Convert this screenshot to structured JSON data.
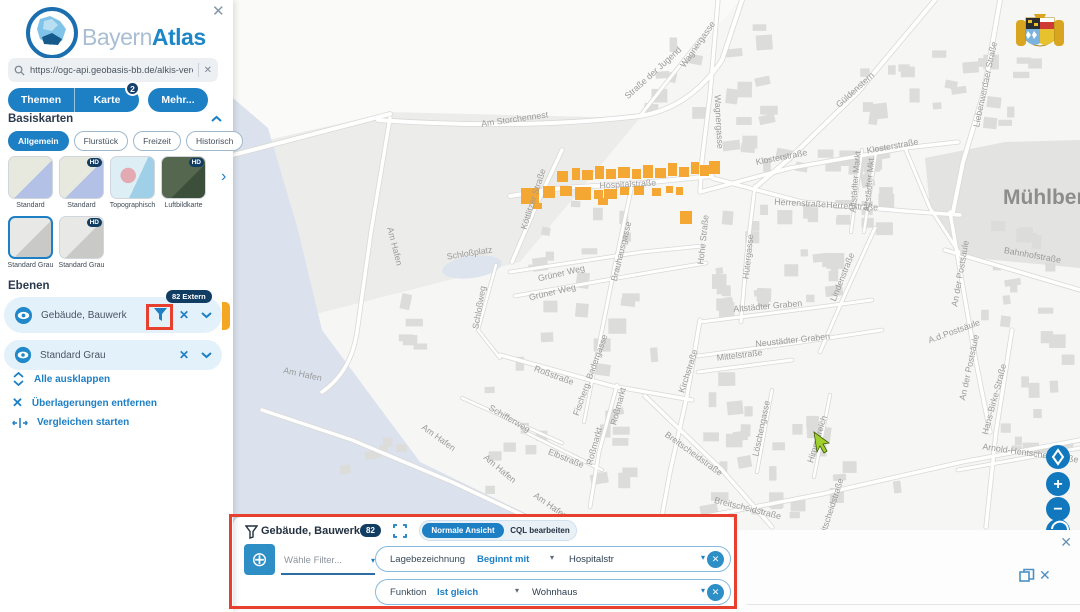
{
  "app": {
    "brand_first": "Bayern",
    "brand_second": "Atlas",
    "close_icon": "✕"
  },
  "search": {
    "value": "https://ogc-api.geobasis-bb.de/alkis-verein",
    "clear_icon": "✕"
  },
  "tabs": [
    {
      "label": "Themen"
    },
    {
      "label": "Karte",
      "badge": "2"
    },
    {
      "label": "Mehr..."
    }
  ],
  "basiskarten": {
    "title": "Basiskarten",
    "chips": [
      {
        "label": "Allgemein",
        "selected": true
      },
      {
        "label": "Flurstück",
        "selected": false
      },
      {
        "label": "Freizeit",
        "selected": false
      },
      {
        "label": "Historisch",
        "selected": false
      }
    ],
    "thumbnails": [
      {
        "label": "Standard",
        "hd": false,
        "selected": false,
        "variant": "standard",
        "row": 0,
        "col": 0
      },
      {
        "label": "Standard",
        "hd": true,
        "selected": false,
        "variant": "standard",
        "row": 0,
        "col": 1
      },
      {
        "label": "Topographisch",
        "hd": false,
        "selected": false,
        "variant": "topo",
        "row": 0,
        "col": 2
      },
      {
        "label": "Luftbildkarte",
        "hd": true,
        "selected": false,
        "variant": "aerial",
        "row": 0,
        "col": 3
      },
      {
        "label": "Standard Grau",
        "hd": false,
        "selected": true,
        "variant": "gray",
        "row": 1,
        "col": 0
      },
      {
        "label": "Standard Grau",
        "hd": true,
        "selected": false,
        "variant": "gray",
        "row": 1,
        "col": 1
      }
    ]
  },
  "ebenen": {
    "title": "Ebenen",
    "layers": [
      {
        "name": "Gebäude, Bauwerk",
        "badge": "82 Extern"
      },
      {
        "name": "Standard Grau"
      }
    ],
    "actions": [
      {
        "label": "Alle ausklappen",
        "icon": "expand-all"
      },
      {
        "label": "Überlagerungen entfernen",
        "icon": "remove-overlays"
      },
      {
        "label": "Vergleichen starten",
        "icon": "compare"
      }
    ]
  },
  "filter_panel": {
    "title": "Gebäude, Bauwerk",
    "count": "82",
    "view_active": "Normale Ansicht",
    "view_inactive": "CQL bearbeiten",
    "add_placeholder": "Wähle Filter...",
    "rows": [
      {
        "field": "Lagebezeichnung",
        "operator": "Beginnt mit",
        "value": "Hospitalstr"
      },
      {
        "field": "Funktion",
        "operator": "Ist gleich",
        "value": "Wohnhaus"
      }
    ],
    "remove_icon": "✕"
  },
  "map_controls": {
    "zoom_in": "+",
    "zoom_out": "−"
  },
  "strip": {
    "close_icon": "✕",
    "close_icon2": "✕"
  },
  "colors": {
    "accent": "#1d7fc4",
    "navy_badge": "#123d63",
    "annotation_red": "#e8402e",
    "building_orange": "#f5a733",
    "control_blue": "#1178be"
  },
  "map": {
    "big_label": "Mühlberg",
    "labels": [
      {
        "t": "Am Storchennest",
        "x": 515,
        "y": 122,
        "r": -8
      },
      {
        "t": "Straße der Jugend",
        "x": 655,
        "y": 75,
        "r": -42
      },
      {
        "t": "Wagnergasse",
        "x": 700,
        "y": 46,
        "r": -55
      },
      {
        "t": "Wagnergasse",
        "x": 716,
        "y": 122,
        "r": 87
      },
      {
        "t": "Güldenstern",
        "x": 857,
        "y": 92,
        "r": -42
      },
      {
        "t": "Liebenwerdaer Straße",
        "x": 988,
        "y": 85,
        "r": -78
      },
      {
        "t": "Klosterstraße",
        "x": 782,
        "y": 160,
        "r": -11
      },
      {
        "t": "Klosterstraße",
        "x": 893,
        "y": 149,
        "r": -10
      },
      {
        "t": "Hospitalstraße",
        "x": 628,
        "y": 187,
        "r": -3
      },
      {
        "t": "Köttlitzer Straße",
        "x": 536,
        "y": 200,
        "r": -72
      },
      {
        "t": "Herrenstraße",
        "x": 800,
        "y": 206,
        "r": 3
      },
      {
        "t": "Herrenstraße",
        "x": 852,
        "y": 209,
        "r": 3
      },
      {
        "t": "Schloßplatz",
        "x": 470,
        "y": 256,
        "r": -9
      },
      {
        "t": "Grüner Weg",
        "x": 562,
        "y": 276,
        "r": -13
      },
      {
        "t": "Grüner Weg",
        "x": 553,
        "y": 295,
        "r": -13
      },
      {
        "t": "Schloßweg",
        "x": 482,
        "y": 308,
        "r": -80
      },
      {
        "t": "Am Hafen",
        "x": 392,
        "y": 247,
        "r": 76
      },
      {
        "t": "Am Hafen",
        "x": 302,
        "y": 377,
        "r": 12
      },
      {
        "t": "Am Hafen",
        "x": 437,
        "y": 440,
        "r": 36
      },
      {
        "t": "Am Hafen",
        "x": 498,
        "y": 471,
        "r": 40
      },
      {
        "t": "Am Hafen",
        "x": 549,
        "y": 508,
        "r": 35
      },
      {
        "t": "Schifferweg",
        "x": 508,
        "y": 421,
        "r": 30
      },
      {
        "t": "Elbstraße",
        "x": 565,
        "y": 461,
        "r": 22
      },
      {
        "t": "Roßmarkt",
        "x": 597,
        "y": 447,
        "r": -75
      },
      {
        "t": "Roßmarkt",
        "x": 621,
        "y": 407,
        "r": -75
      },
      {
        "t": "Roßstraße",
        "x": 553,
        "y": 378,
        "r": 20
      },
      {
        "t": "Fischerg. Badergasse",
        "x": 593,
        "y": 376,
        "r": -70
      },
      {
        "t": "Brauhausgasse",
        "x": 624,
        "y": 252,
        "r": -76
      },
      {
        "t": "Hohe Straße",
        "x": 706,
        "y": 240,
        "r": -84
      },
      {
        "t": "Hütergasse",
        "x": 751,
        "y": 257,
        "r": -84
      },
      {
        "t": "Kirchstraße",
        "x": 691,
        "y": 372,
        "r": -72
      },
      {
        "t": "Altstädter Graben",
        "x": 768,
        "y": 309,
        "r": -5
      },
      {
        "t": "Neustädter Graben",
        "x": 793,
        "y": 343,
        "r": -6
      },
      {
        "t": "Mittelstraße",
        "x": 740,
        "y": 358,
        "r": -7
      },
      {
        "t": "Breitscheidstraße",
        "x": 692,
        "y": 456,
        "r": 36
      },
      {
        "t": "Breitscheidstraße",
        "x": 747,
        "y": 511,
        "r": 14
      },
      {
        "t": "Breitscheidstraße",
        "x": 833,
        "y": 512,
        "r": -72
      },
      {
        "t": "Löschengasse",
        "x": 764,
        "y": 429,
        "r": -78
      },
      {
        "t": "Himmelreich",
        "x": 820,
        "y": 440,
        "r": -73
      },
      {
        "t": "Lindenstraße",
        "x": 845,
        "y": 278,
        "r": -68
      },
      {
        "t": "Altstädter Markt",
        "x": 858,
        "y": 182,
        "r": -85
      },
      {
        "t": "Altstädter Mkt.",
        "x": 872,
        "y": 184,
        "r": -85
      },
      {
        "t": "An der Postsäule",
        "x": 963,
        "y": 274,
        "r": -80
      },
      {
        "t": "An der Postsäule",
        "x": 972,
        "y": 368,
        "r": -78
      },
      {
        "t": "A.d.Postsäule",
        "x": 955,
        "y": 334,
        "r": -20
      },
      {
        "t": "Bahnhofstraße",
        "x": 1032,
        "y": 258,
        "r": 10
      },
      {
        "t": "Hans-Birke-Straße",
        "x": 997,
        "y": 400,
        "r": -75
      },
      {
        "t": "Arnold-Hentschel-Straße",
        "x": 1030,
        "y": 456,
        "r": 8
      }
    ],
    "orange_buildings": [
      [
        521,
        188,
        18,
        16
      ],
      [
        543,
        186,
        12,
        12
      ],
      [
        557,
        171,
        11,
        11
      ],
      [
        572,
        168,
        8,
        12
      ],
      [
        582,
        170,
        11,
        10
      ],
      [
        595,
        166,
        9,
        13
      ],
      [
        606,
        169,
        10,
        10
      ],
      [
        618,
        167,
        12,
        11
      ],
      [
        632,
        169,
        9,
        10
      ],
      [
        643,
        165,
        10,
        13
      ],
      [
        655,
        168,
        11,
        10
      ],
      [
        668,
        163,
        9,
        13
      ],
      [
        679,
        167,
        10,
        10
      ],
      [
        691,
        162,
        8,
        12
      ],
      [
        700,
        165,
        9,
        11
      ],
      [
        709,
        161,
        11,
        13
      ],
      [
        575,
        187,
        16,
        13
      ],
      [
        560,
        186,
        12,
        10
      ],
      [
        594,
        190,
        9,
        9
      ],
      [
        604,
        189,
        13,
        10
      ],
      [
        620,
        187,
        9,
        8
      ],
      [
        634,
        186,
        10,
        9
      ],
      [
        598,
        198,
        10,
        7
      ],
      [
        652,
        188,
        9,
        8
      ],
      [
        666,
        186,
        7,
        7
      ],
      [
        676,
        187,
        7,
        8
      ],
      [
        680,
        211,
        12,
        13
      ],
      [
        533,
        203,
        9,
        6
      ]
    ]
  }
}
